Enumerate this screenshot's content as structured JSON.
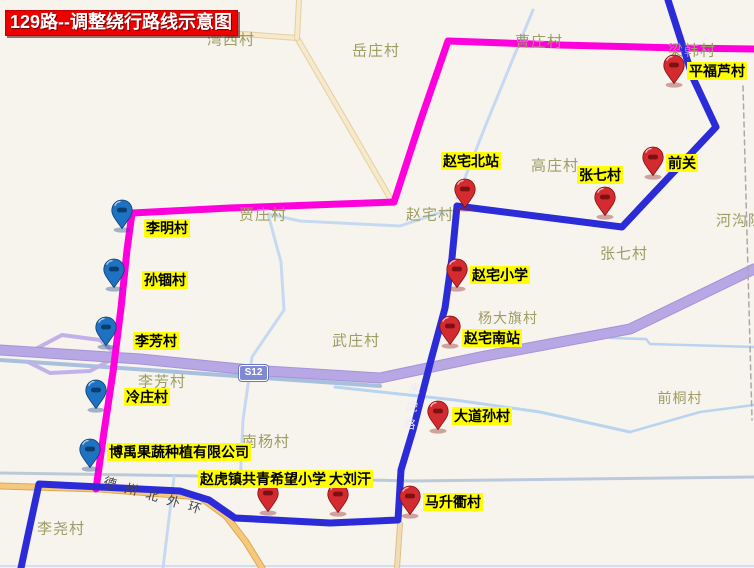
{
  "title": {
    "text": "129路--调整绕行路线示意图"
  },
  "shield": {
    "text": "S12"
  },
  "road_names": {
    "ring": "德州北外环",
    "mihu": "米虎路"
  },
  "colors": {
    "background": "#f7f4ed",
    "magenta_route": "#ff00dc",
    "blue_route": "#2b2bd8",
    "expressway": "#b7a8e5",
    "minor_road": "#c7d9f1",
    "stop_label_bg": "#ffff00",
    "village_text": "#9c9c64",
    "title_bg": "#ec0000"
  },
  "pin_colors": {
    "red": {
      "fill": "#d42b30",
      "dark": "#7d1013",
      "shadow": "rgba(150,40,40,0.4)"
    },
    "blue": {
      "fill": "#1e72c2",
      "dark": "#0b3d6e",
      "shadow": "rgba(40,80,140,0.4)"
    }
  },
  "map_labels": [
    {
      "text": "湾西村",
      "x": 231,
      "y": 39
    },
    {
      "text": "岳庄村",
      "x": 376,
      "y": 50
    },
    {
      "text": "曹庄村",
      "x": 539,
      "y": 41
    },
    {
      "text": "梁韩村",
      "x": 692,
      "y": 50
    },
    {
      "text": "高庄村",
      "x": 555,
      "y": 165
    },
    {
      "text": "河沟陈",
      "x": 740,
      "y": 220
    },
    {
      "text": "张七村",
      "x": 624,
      "y": 253
    },
    {
      "text": "贾庄村",
      "x": 263,
      "y": 214
    },
    {
      "text": "赵宅村",
      "x": 430,
      "y": 214
    },
    {
      "text": "武庄村",
      "x": 356,
      "y": 340
    },
    {
      "text": "杨大旗村",
      "x": 508,
      "y": 318,
      "size": 14
    },
    {
      "text": "李芳村",
      "x": 162,
      "y": 381
    },
    {
      "text": "南杨村",
      "x": 266,
      "y": 441
    },
    {
      "text": "前桐村",
      "x": 680,
      "y": 398,
      "size": 14
    },
    {
      "text": "李尧村",
      "x": 61,
      "y": 528
    }
  ],
  "stops": [
    {
      "name": "平福芦村",
      "color": "red",
      "pin_x": 674,
      "pin_y": 86,
      "label_x": 687,
      "label_y": 62
    },
    {
      "name": "赵宅北站",
      "color": "red",
      "pin_x": 465,
      "pin_y": 210,
      "label_x": 441,
      "label_y": 152
    },
    {
      "name": "张七村",
      "color": "red",
      "pin_x": 605,
      "pin_y": 218,
      "label_x": 577,
      "label_y": 166
    },
    {
      "name": "前关",
      "color": "red",
      "pin_x": 653,
      "pin_y": 178,
      "label_x": 666,
      "label_y": 154
    },
    {
      "name": "赵宅小学",
      "color": "red",
      "pin_x": 457,
      "pin_y": 290,
      "label_x": 470,
      "label_y": 266
    },
    {
      "name": "赵宅南站",
      "color": "red",
      "pin_x": 450,
      "pin_y": 347,
      "label_x": 462,
      "label_y": 329
    },
    {
      "name": "大道孙村",
      "color": "red",
      "pin_x": 438,
      "pin_y": 432,
      "label_x": 452,
      "label_y": 407
    },
    {
      "name": "赵虎镇共青希望小学",
      "color": "red",
      "pin_x": 268,
      "pin_y": 514,
      "label_x": 198,
      "label_y": 470
    },
    {
      "name": "大刘汗",
      "color": "red",
      "pin_x": 338,
      "pin_y": 515,
      "label_x": 327,
      "label_y": 470
    },
    {
      "name": "马升衢村",
      "color": "red",
      "pin_x": 410,
      "pin_y": 517,
      "label_x": 423,
      "label_y": 493
    },
    {
      "name": "李明村",
      "color": "blue",
      "pin_x": 122,
      "pin_y": 231,
      "label_x": 144,
      "label_y": 219
    },
    {
      "name": "孙锢村",
      "color": "blue",
      "pin_x": 114,
      "pin_y": 290,
      "label_x": 142,
      "label_y": 271
    },
    {
      "name": "李芳村",
      "color": "blue",
      "pin_x": 106,
      "pin_y": 348,
      "label_x": 133,
      "label_y": 332
    },
    {
      "name": "冷庄村",
      "color": "blue",
      "pin_x": 96,
      "pin_y": 411,
      "label_x": 124,
      "label_y": 388
    },
    {
      "name": "博禹果蔬种植有限公司",
      "color": "blue",
      "pin_x": 90,
      "pin_y": 470,
      "label_x": 107,
      "label_y": 443
    }
  ],
  "roads": [
    {
      "id": "bottom-ring-road",
      "color": "#bcc9da",
      "width": 3,
      "points": [
        [
          0,
          473
        ],
        [
          200,
          476
        ],
        [
          410,
          481
        ],
        [
          754,
          477
        ]
      ]
    },
    {
      "id": "bottom-edge-river",
      "color": "#cfe0f2",
      "width": 2,
      "points": [
        [
          0,
          566
        ],
        [
          754,
          566
        ]
      ]
    },
    {
      "id": "tan-road-north",
      "color": "#f6e9cc",
      "width": 4,
      "casing": "#e5cfa2",
      "casing_width": 6,
      "points": [
        [
          160,
          28
        ],
        [
          297,
          38
        ],
        [
          345,
          120
        ],
        [
          393,
          203
        ]
      ]
    },
    {
      "id": "tan-road-north-stub",
      "color": "#f6e9cc",
      "width": 4,
      "casing": "#e5cfa2",
      "casing_width": 6,
      "points": [
        [
          299,
          0
        ],
        [
          297,
          38
        ]
      ]
    },
    {
      "id": "minor-road-caozhuang",
      "color": "#c7d9f1",
      "width": 3,
      "points": [
        [
          533,
          10
        ],
        [
          487,
          122
        ],
        [
          457,
          198
        ]
      ]
    },
    {
      "id": "minor-road-zhaozhai-west",
      "color": "#c7d9f1",
      "width": 3,
      "points": [
        [
          448,
          210
        ],
        [
          400,
          226
        ],
        [
          300,
          221
        ],
        [
          268,
          214
        ]
      ]
    },
    {
      "id": "minor-road-jiazhuang-south",
      "color": "#c7d9f1",
      "width": 3,
      "points": [
        [
          268,
          214
        ],
        [
          281,
          262
        ],
        [
          284,
          310
        ],
        [
          252,
          357
        ],
        [
          243,
          420
        ],
        [
          240,
          487
        ]
      ]
    },
    {
      "id": "minor-road-southwest",
      "color": "#c7d9f1",
      "width": 3,
      "points": [
        [
          174,
          477
        ],
        [
          163,
          568
        ]
      ]
    },
    {
      "id": "river-central",
      "color": "#b9d4ee",
      "width": 3,
      "points": [
        [
          335,
          387
        ],
        [
          455,
          400
        ],
        [
          540,
          412
        ],
        [
          630,
          432
        ]
      ]
    },
    {
      "id": "river-east-upper",
      "color": "#b9d4ee",
      "width": 2.5,
      "points": [
        [
          610,
          338
        ],
        [
          646,
          339
        ],
        [
          650,
          344
        ],
        [
          754,
          347
        ]
      ]
    },
    {
      "id": "river-east-lower",
      "color": "#b9d4ee",
      "width": 2.5,
      "points": [
        [
          630,
          432
        ],
        [
          700,
          412
        ],
        [
          754,
          405
        ]
      ]
    },
    {
      "id": "s12-side-road",
      "color": "#a9bfde",
      "width": 4,
      "points": [
        [
          0,
          360
        ],
        [
          120,
          368
        ],
        [
          250,
          377
        ],
        [
          380,
          386
        ]
      ]
    },
    {
      "id": "expressway-interchange-ramp",
      "color": "#c0b2e8",
      "width": 4,
      "points": [
        [
          28,
          353
        ],
        [
          62,
          335
        ],
        [
          100,
          340
        ],
        [
          118,
          356
        ],
        [
          90,
          371
        ],
        [
          50,
          373
        ],
        [
          28,
          362
        ]
      ]
    },
    {
      "id": "expressway-s12",
      "color": "#b7a8e5",
      "width": 9,
      "casing": "#a493d8",
      "casing_width": 11,
      "points": [
        [
          0,
          350
        ],
        [
          140,
          359
        ],
        [
          250,
          370
        ],
        [
          380,
          378
        ],
        [
          480,
          357
        ],
        [
          630,
          329
        ],
        [
          754,
          269
        ]
      ]
    },
    {
      "id": "orange-ring-branch",
      "color": "#f6c87e",
      "width": 5,
      "casing": "#dfa850",
      "casing_width": 7,
      "points": [
        [
          0,
          486
        ],
        [
          100,
          489
        ],
        [
          200,
          497
        ],
        [
          226,
          516
        ],
        [
          246,
          542
        ],
        [
          262,
          568
        ]
      ]
    },
    {
      "id": "orange-road-south",
      "color": "#f0ddb8",
      "width": 4,
      "casing": "#ddc08a",
      "casing_width": 6,
      "points": [
        [
          400,
          524
        ],
        [
          397,
          568
        ]
      ]
    },
    {
      "id": "boundary-dashed-line",
      "color": "#a9a9a9",
      "width": 1.5,
      "dash": "5,4",
      "points": [
        [
          743,
          86
        ],
        [
          752,
          420
        ]
      ]
    }
  ],
  "routes": [
    {
      "id": "route-129-magenta",
      "color": "#ff00dc",
      "width": 7,
      "points": [
        [
          96,
          489
        ],
        [
          104,
          432
        ],
        [
          113,
          372
        ],
        [
          121,
          308
        ],
        [
          127,
          250
        ],
        [
          132,
          213
        ],
        [
          230,
          208
        ],
        [
          340,
          204
        ],
        [
          394,
          202
        ],
        [
          420,
          122
        ],
        [
          448,
          41
        ],
        [
          560,
          45
        ],
        [
          680,
          48
        ],
        [
          754,
          49
        ]
      ]
    },
    {
      "id": "route-129-blue",
      "color": "#2b2bd8",
      "width": 7,
      "points": [
        [
          668,
          0
        ],
        [
          693,
          78
        ],
        [
          716,
          127
        ],
        [
          622,
          227
        ],
        [
          457,
          206
        ],
        [
          452,
          258
        ],
        [
          445,
          308
        ],
        [
          431,
          360
        ],
        [
          413,
          430
        ],
        [
          401,
          470
        ],
        [
          398,
          520
        ],
        [
          330,
          523
        ],
        [
          235,
          518
        ],
        [
          209,
          500
        ],
        [
          180,
          491
        ],
        [
          100,
          487
        ],
        [
          39,
          484
        ],
        [
          28,
          535
        ],
        [
          21,
          568
        ]
      ]
    }
  ]
}
